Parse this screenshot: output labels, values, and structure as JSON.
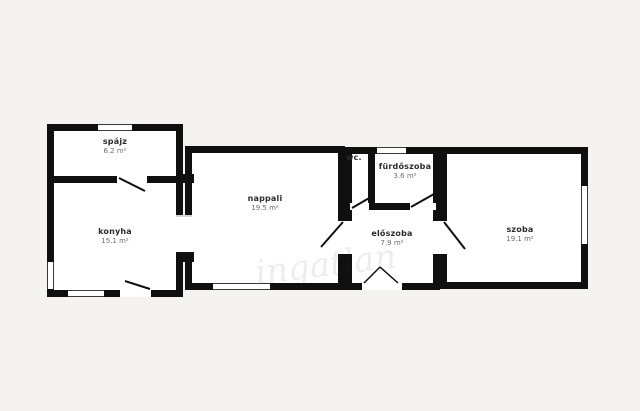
{
  "plan": {
    "background_color": "#f4f3f0",
    "wall_color": "#0f0f0f",
    "room_fill": "#ffffff",
    "label_color": "#2b2b2b",
    "area_color": "#6e6e6e"
  },
  "rooms": [
    {
      "id": "spajz",
      "name": "spájz",
      "area": "6.2 m²"
    },
    {
      "id": "konyha",
      "name": "konyha",
      "area": "15.1 m²"
    },
    {
      "id": "nappali",
      "name": "nappali",
      "area": "19.5 m²"
    },
    {
      "id": "wc",
      "name": "wc.",
      "area": ""
    },
    {
      "id": "furdoszoba",
      "name": "fürdőszoba",
      "area": "3.6 m²"
    },
    {
      "id": "eloszoba",
      "name": "előszoba",
      "area": "7.9 m²"
    },
    {
      "id": "szoba",
      "name": "szoba",
      "area": "19.1 m²"
    }
  ],
  "watermark": "ingatlan"
}
